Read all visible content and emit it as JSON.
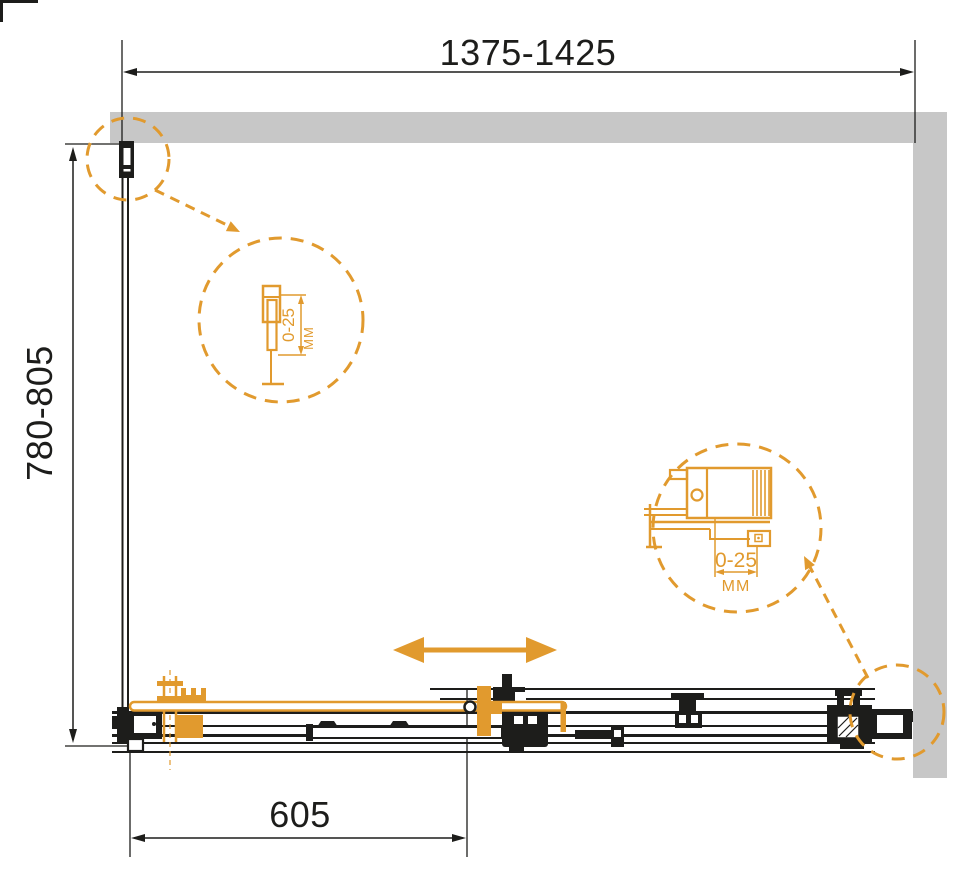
{
  "colors": {
    "accent": "#E19A2E",
    "wall": "#C7C7C7",
    "line": "#1D1D1B",
    "bg": "#FFFFFF"
  },
  "dimensions": {
    "overall_width": {
      "label": "1375-1425"
    },
    "overall_depth": {
      "label": "780-805"
    },
    "door_panel": {
      "label": "605"
    }
  },
  "adjustment_details": {
    "left_wall_profile": {
      "range": "0-25",
      "unit": "ММ"
    },
    "right_wall_profile": {
      "range": "0-25",
      "unit": "ММ"
    }
  }
}
